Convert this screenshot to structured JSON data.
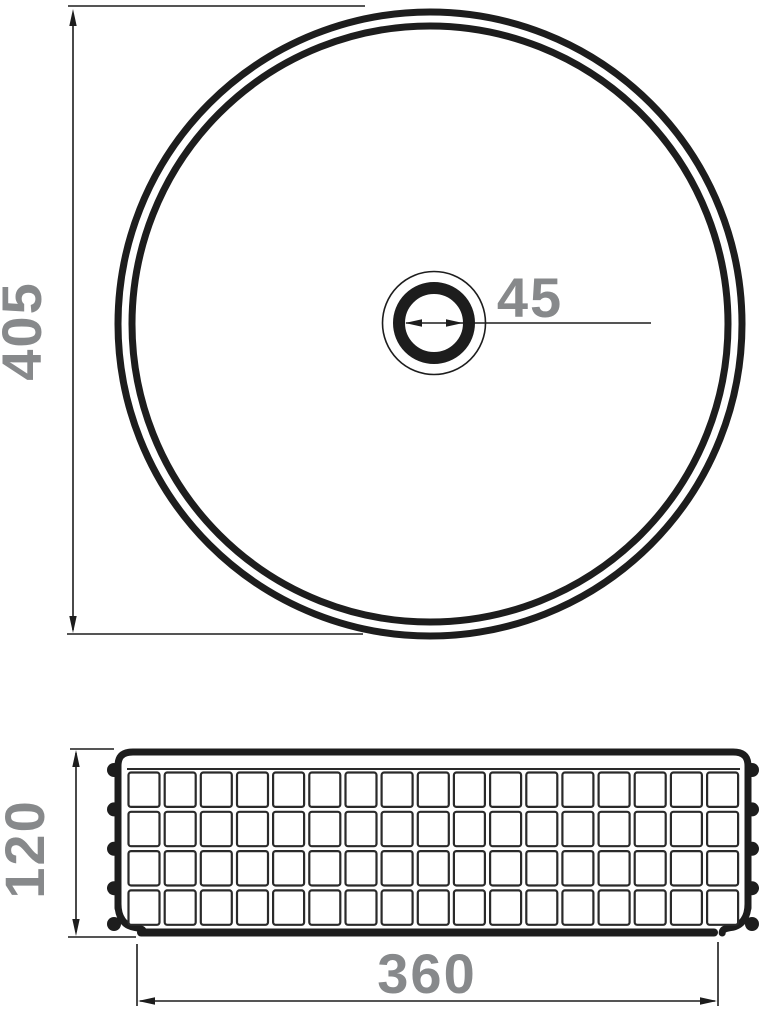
{
  "colors": {
    "line": "#1d1d1d",
    "dimension_label": "#87898b",
    "background": "#ffffff"
  },
  "dimensions": {
    "top_view_diameter": "405",
    "drain_diameter": "45",
    "side_view_height": "120",
    "base_width": "360"
  }
}
